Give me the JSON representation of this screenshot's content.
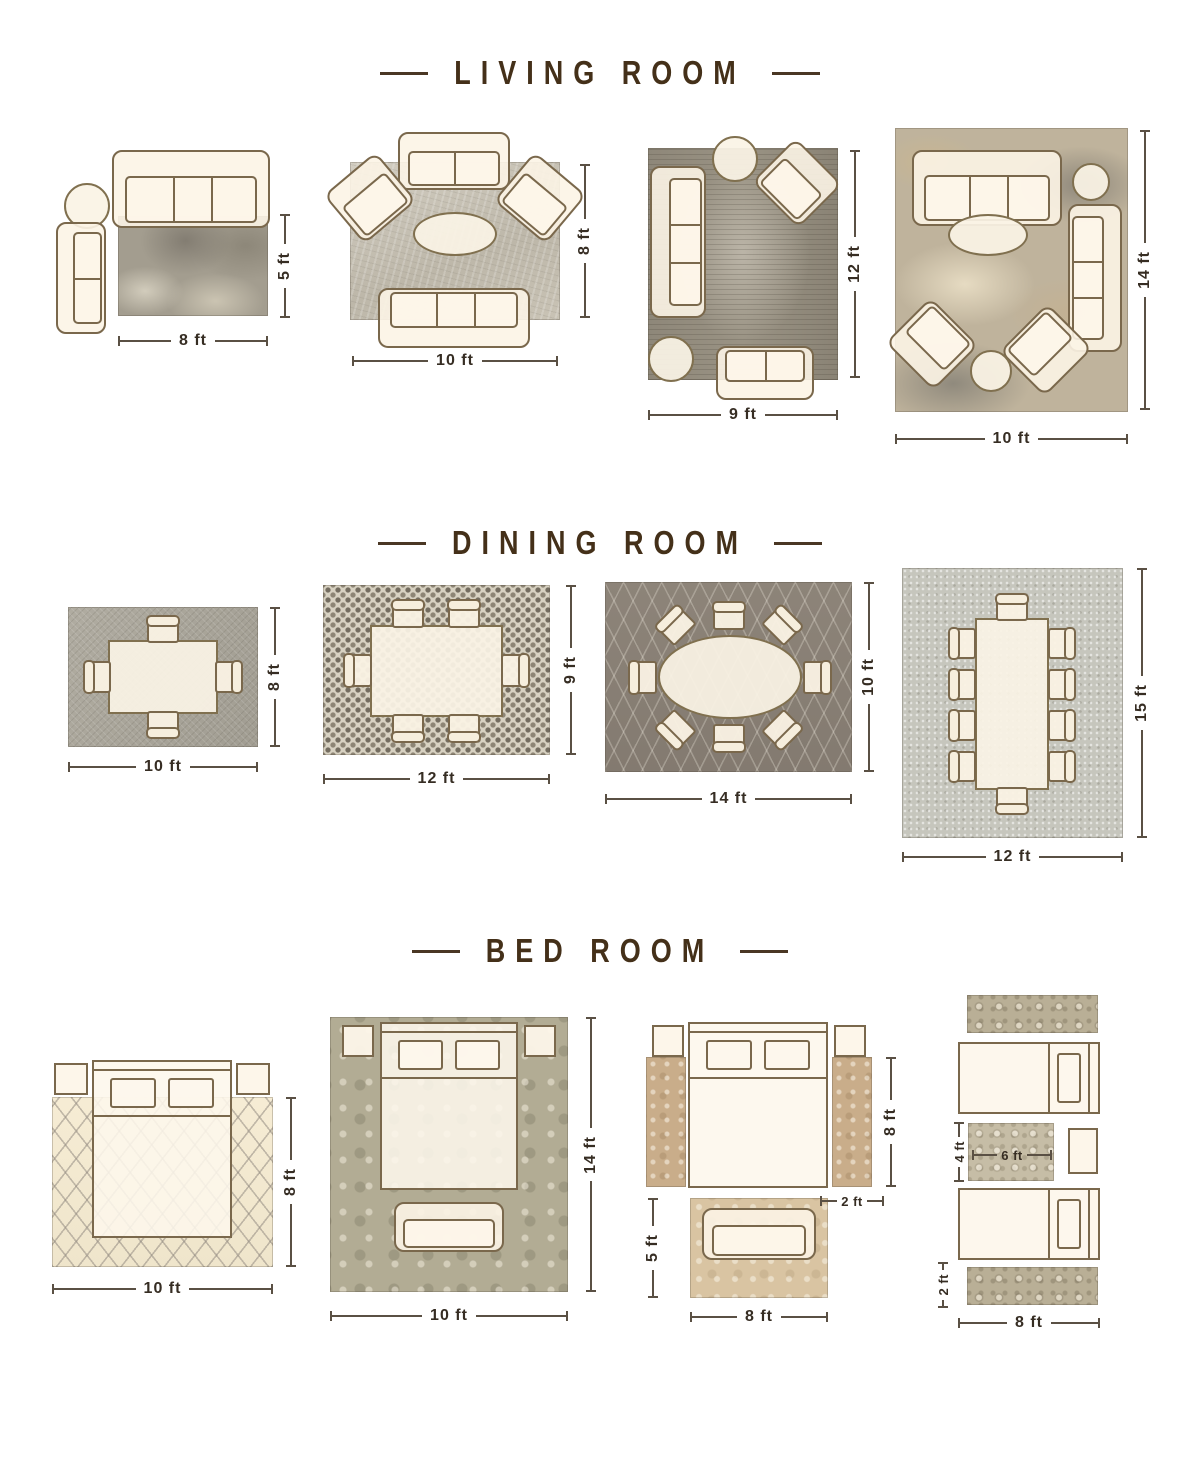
{
  "colors": {
    "background": "#ffffff",
    "title_text": "#443019",
    "dimension_text": "#362d23",
    "furniture_outline": "#7a684c",
    "furniture_fill": "#fbf3e4"
  },
  "sections": {
    "living": {
      "title": "LIVING ROOM",
      "layouts": [
        {
          "width": "8 ft",
          "height": "5 ft"
        },
        {
          "width": "10 ft",
          "height": "8 ft"
        },
        {
          "width": "9 ft",
          "height": "12 ft"
        },
        {
          "width": "10 ft",
          "height": "14 ft"
        }
      ]
    },
    "dining": {
      "title": "DINING ROOM",
      "layouts": [
        {
          "width": "10 ft",
          "height": "8 ft"
        },
        {
          "width": "12 ft",
          "height": "9 ft"
        },
        {
          "width": "14 ft",
          "height": "10 ft"
        },
        {
          "width": "12 ft",
          "height": "15 ft"
        }
      ]
    },
    "bedroom": {
      "title": "BED ROOM",
      "layouts": [
        {
          "width": "10 ft",
          "height": "8 ft"
        },
        {
          "width": "10 ft",
          "height": "14 ft"
        },
        {
          "bed_height": "8 ft",
          "runner_width": "2 ft",
          "rug_height": "5 ft",
          "rug_width": "8 ft"
        },
        {
          "small_rug_height": "4 ft",
          "small_rug_width": "6 ft",
          "runner_width": "2 ft",
          "width": "8 ft"
        }
      ]
    }
  }
}
